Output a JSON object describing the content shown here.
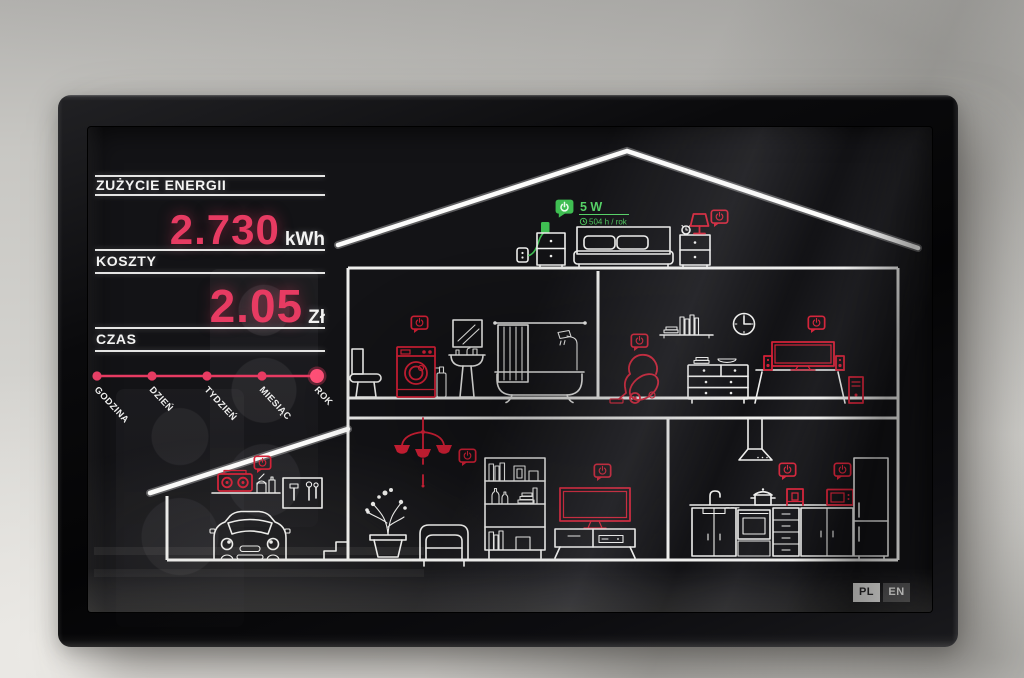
{
  "screen": {
    "panel": {
      "energy": {
        "label": "ZUŻYCIE ENERGII",
        "value": "2.730",
        "unit": "kWh"
      },
      "cost": {
        "label": "KOSZTY",
        "value": "2.05",
        "unit": "Zł"
      },
      "time": {
        "label": "CZAS",
        "options": [
          "GODZINA",
          "DZIEŃ",
          "TYDZIEŃ",
          "MIESIĄC",
          "ROK"
        ],
        "selected": "ROK"
      }
    },
    "active_device": {
      "power": "5 W",
      "usage": "504 h / rok"
    },
    "language": {
      "options": [
        "PL",
        "EN"
      ],
      "selected": "PL"
    }
  },
  "colors": {
    "accent": "#e73b62",
    "red": "#d42036",
    "green": "#3fbe52",
    "line": "#f2f2f2"
  },
  "icons": {
    "device_indicator": "power-bubble-icon",
    "active_device_power": "power-icon",
    "usage_time": "clock-icon"
  }
}
